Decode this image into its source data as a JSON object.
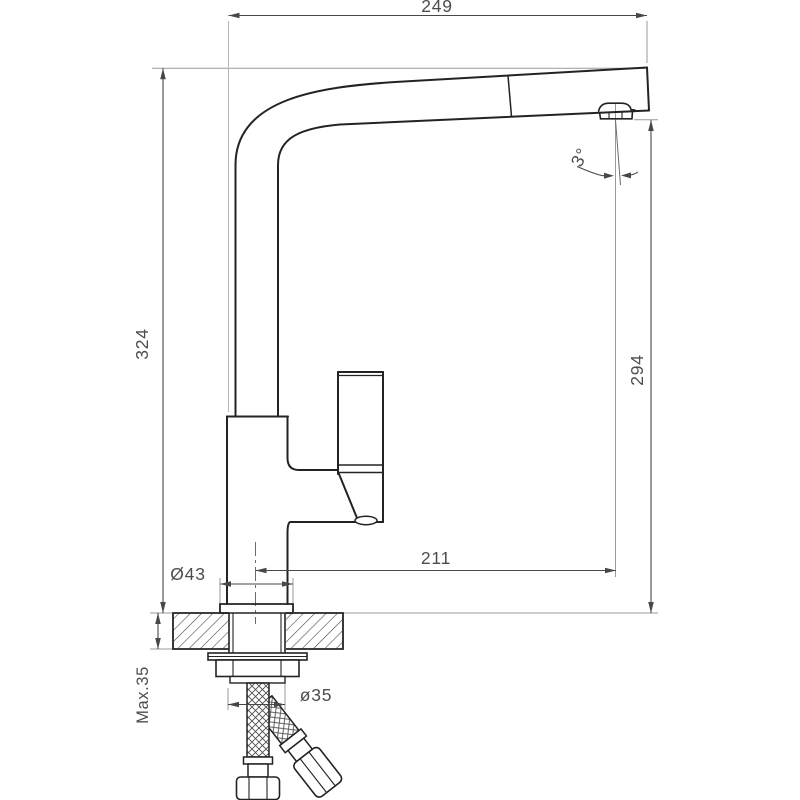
{
  "drawing": {
    "title": "pull-out-kitchen-faucet-dimension-drawing",
    "dimensions": {
      "spout_reach": "249",
      "total_height": "324",
      "spout_outlet_height": "294",
      "spout_outlet_reach": "211",
      "base_diameter": "Ø43",
      "mounting_hole_diameter": "ø35",
      "max_deck_thickness": "Max.35",
      "spout_tilt_angle": "3°"
    },
    "colors": {
      "outline": "#232323",
      "dimension_line": "#474747",
      "extension_line": "#9a9a9a",
      "text": "#4d4d4d",
      "background": "#ffffff"
    }
  }
}
